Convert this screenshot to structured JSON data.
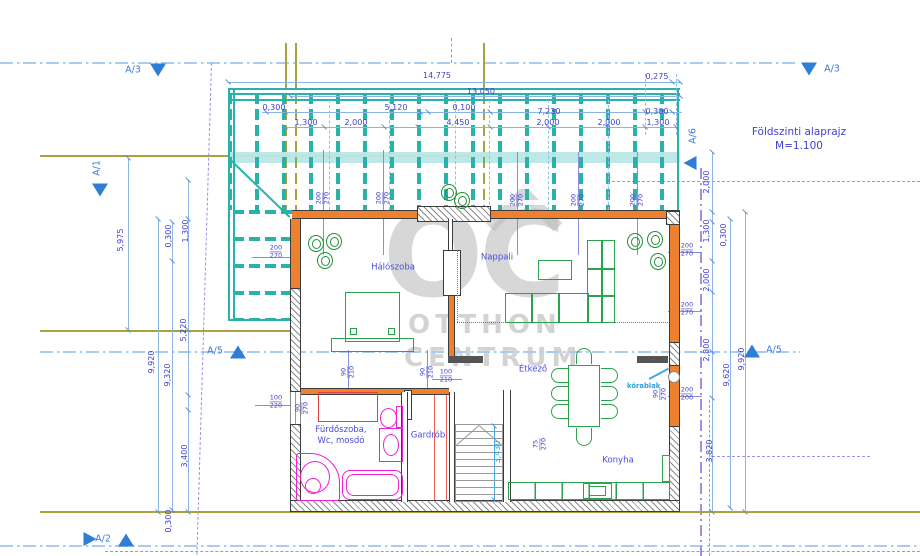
{
  "title": {
    "line1": "Földszinti alaprajz",
    "line2": "M=1.100"
  },
  "watermark": {
    "logo": "OC",
    "word1": "OTTHON",
    "word2": "CENTRUM"
  },
  "annotations": {
    "korablak": "körablak"
  },
  "rooms": [
    {
      "label": "Hálószoba",
      "x": 393,
      "y": 268
    },
    {
      "label": "Nappali",
      "x": 497,
      "y": 258
    },
    {
      "label": "Étkező",
      "x": 533,
      "y": 370
    },
    {
      "label": "Konyha",
      "x": 618,
      "y": 461
    },
    {
      "label": "Fürdőszoba,\nWc, mosdó",
      "x": 341,
      "y": 436
    },
    {
      "label": "Gardrób",
      "x": 428,
      "y": 436
    }
  ],
  "markers": [
    {
      "label": "A/3",
      "lx": 133,
      "ly": 70,
      "rot": 0,
      "tri": "down",
      "tx": 158,
      "ty": 70
    },
    {
      "label": "A/3",
      "lx": 832,
      "ly": 69,
      "rot": 0,
      "tri": "down",
      "tx": 809,
      "ty": 69
    },
    {
      "label": "A/1",
      "lx": 97,
      "ly": 168,
      "rot": 1,
      "tri": "down",
      "tx": 100,
      "ty": 190
    },
    {
      "label": "A/6",
      "lx": 693,
      "ly": 136,
      "rot": 1,
      "tri": "left",
      "tx": 690,
      "ty": 163
    },
    {
      "label": "A/5",
      "lx": 215,
      "ly": 351,
      "rot": 0,
      "tri": "up",
      "tx": 238,
      "ty": 352
    },
    {
      "label": "A/5",
      "lx": 774,
      "ly": 350,
      "rot": 0,
      "tri": "up",
      "tx": 752,
      "ty": 351
    },
    {
      "label": "A/2",
      "lx": 103,
      "ly": 539,
      "rot": 0,
      "tri": "right",
      "tx": 90,
      "ty": 539
    },
    {
      "label": "",
      "lx": 0,
      "ly": 0,
      "rot": 0,
      "tri": "up",
      "tx": 126,
      "ty": 540
    }
  ],
  "dims": [
    {
      "t": "14,775",
      "x": 437,
      "y": 76
    },
    {
      "t": "0,275",
      "x": 657,
      "y": 77
    },
    {
      "t": "13,050",
      "x": 481,
      "y": 92
    },
    {
      "t": "0,300",
      "x": 274,
      "y": 108
    },
    {
      "t": "5,120",
      "x": 396,
      "y": 108
    },
    {
      "t": "0,100",
      "x": 464,
      "y": 108
    },
    {
      "t": "7,230",
      "x": 549,
      "y": 112
    },
    {
      "t": "0,300",
      "x": 657,
      "y": 112
    },
    {
      "t": "1,300",
      "x": 306,
      "y": 123
    },
    {
      "t": "2,000",
      "x": 356,
      "y": 123
    },
    {
      "t": "4,450",
      "x": 458,
      "y": 123
    },
    {
      "t": "2,000",
      "x": 548,
      "y": 123
    },
    {
      "t": "2,000",
      "x": 609,
      "y": 123
    },
    {
      "t": "1,300",
      "x": 658,
      "y": 123
    },
    {
      "t": "5,975",
      "x": 121,
      "y": 240,
      "r": 1
    },
    {
      "t": "0,300",
      "x": 169,
      "y": 236,
      "r": 1
    },
    {
      "t": "1,300",
      "x": 186,
      "y": 231,
      "r": 1
    },
    {
      "t": "5,220",
      "x": 184,
      "y": 330,
      "r": 1
    },
    {
      "t": "9,920",
      "x": 152,
      "y": 362,
      "r": 1
    },
    {
      "t": "9,320",
      "x": 168,
      "y": 375,
      "r": 1
    },
    {
      "t": "3,400",
      "x": 185,
      "y": 456,
      "r": 1
    },
    {
      "t": "0,300",
      "x": 169,
      "y": 521,
      "r": 1
    },
    {
      "t": "2,000",
      "x": 707,
      "y": 182,
      "r": 1
    },
    {
      "t": "1,300",
      "x": 707,
      "y": 231,
      "r": 1
    },
    {
      "t": "0,300",
      "x": 724,
      "y": 235,
      "r": 1
    },
    {
      "t": "2,000",
      "x": 707,
      "y": 280,
      "r": 1
    },
    {
      "t": "2,800",
      "x": 707,
      "y": 350,
      "r": 1
    },
    {
      "t": "9,620",
      "x": 727,
      "y": 375,
      "r": 1
    },
    {
      "t": "9,920",
      "x": 742,
      "y": 359,
      "r": 1
    },
    {
      "t": "3,820",
      "x": 710,
      "y": 451,
      "r": 1
    },
    {
      "t": "3,430",
      "x": 498,
      "y": 452,
      "r": 1,
      "c": "cy"
    }
  ],
  "fracs": [
    {
      "a": "200",
      "b": "270",
      "x": 276,
      "y": 252
    },
    {
      "a": "200",
      "b": "270",
      "x": 323,
      "y": 198,
      "r": 1
    },
    {
      "a": "200",
      "b": "270",
      "x": 383,
      "y": 198,
      "r": 1
    },
    {
      "a": "200",
      "b": "270",
      "x": 517,
      "y": 200,
      "r": 1
    },
    {
      "a": "200",
      "b": "270",
      "x": 578,
      "y": 200,
      "r": 1
    },
    {
      "a": "200",
      "b": "270",
      "x": 637,
      "y": 200,
      "r": 1
    },
    {
      "a": "200",
      "b": "270",
      "x": 687,
      "y": 250
    },
    {
      "a": "200",
      "b": "270",
      "x": 687,
      "y": 309
    },
    {
      "a": "200",
      "b": "200",
      "x": 687,
      "y": 394
    },
    {
      "a": "90",
      "b": "270",
      "x": 660,
      "y": 394,
      "r": 1
    },
    {
      "a": "100",
      "b": "220",
      "x": 276,
      "y": 402
    },
    {
      "a": "90",
      "b": "210",
      "x": 348,
      "y": 372,
      "r": 1
    },
    {
      "a": "90",
      "b": "210",
      "x": 427,
      "y": 372,
      "r": 1
    },
    {
      "a": "100",
      "b": "210",
      "x": 446,
      "y": 376
    },
    {
      "a": "75",
      "b": "270",
      "x": 540,
      "y": 444,
      "r": 1
    },
    {
      "a": "90",
      "b": "270",
      "x": 302,
      "y": 408,
      "r": 1
    }
  ],
  "colors": {
    "pergola_teal": "#27b3a9",
    "wall_orange": "#ee8130",
    "dim_blue": "#4040cf",
    "section_blue": "#2e7ed6",
    "fixture_magenta": "#ef1fd3",
    "furniture_green": "#2ba24b",
    "watermark_gray": "#bdbdbd",
    "boundary_olive": "#a9a23f",
    "stairs_cyan": "#45aadf"
  }
}
